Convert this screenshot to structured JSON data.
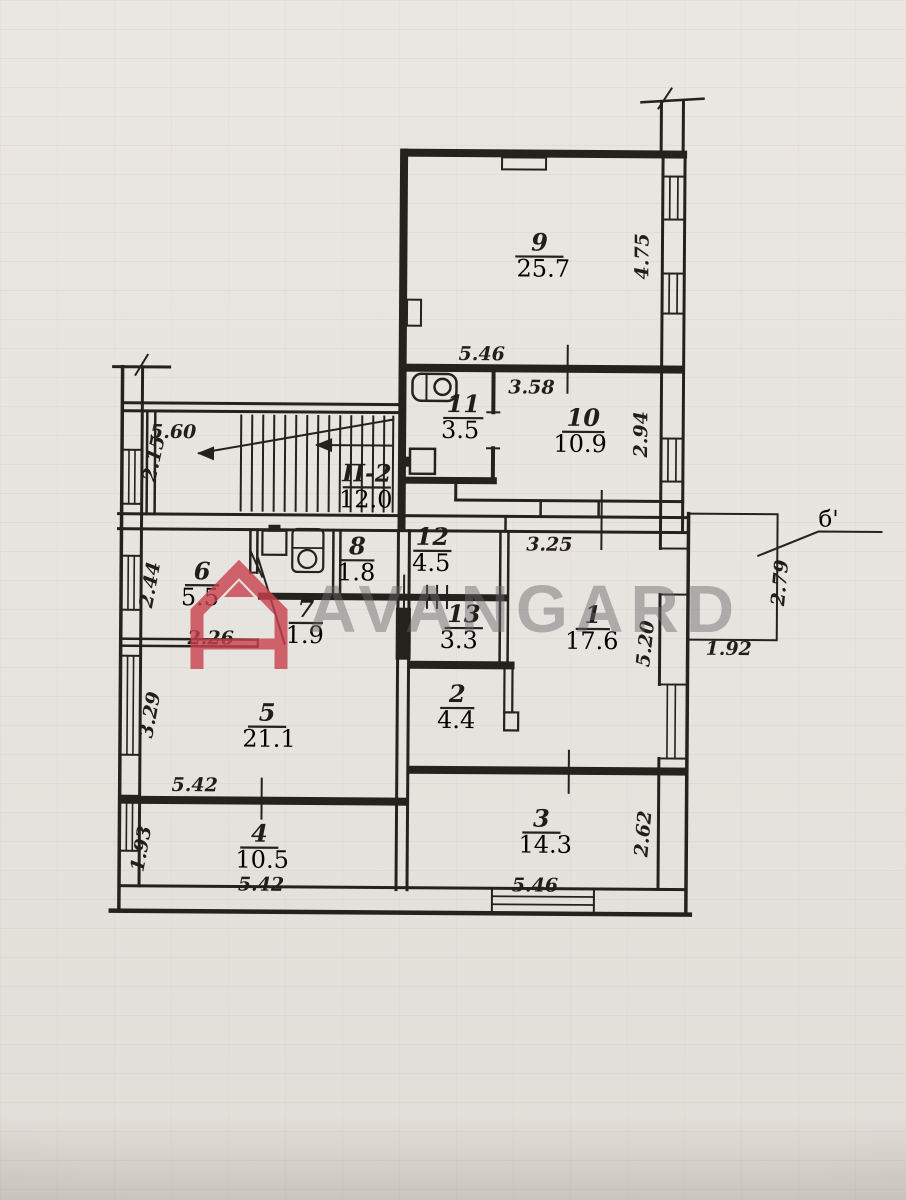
{
  "watermark": {
    "brand": "AVANGARD",
    "logo_letter": "A",
    "logo_color": "#c8414d"
  },
  "plan": {
    "stairs": {
      "label": "П-2",
      "area": "12.0"
    },
    "balcony": {
      "mark": "б'",
      "height": "2.79",
      "width": "1.92"
    },
    "rooms": {
      "r1": {
        "num": "1",
        "area": "17.6"
      },
      "r2": {
        "num": "2",
        "area": "4.4"
      },
      "r3": {
        "num": "3",
        "area": "14.3"
      },
      "r4": {
        "num": "4",
        "area": "10.5"
      },
      "r5": {
        "num": "5",
        "area": "21.1"
      },
      "r6": {
        "num": "6",
        "area": "5.5"
      },
      "r7": {
        "num": "7",
        "area": "1.9"
      },
      "r8": {
        "num": "8",
        "area": "1.8"
      },
      "r9": {
        "num": "9",
        "area": "25.7"
      },
      "r10": {
        "num": "10",
        "area": "10.9"
      },
      "r11": {
        "num": "11",
        "area": "3.5"
      },
      "r12": {
        "num": "12",
        "area": "4.5"
      },
      "r13": {
        "num": "13",
        "area": "3.3"
      }
    },
    "dims": {
      "room9_side": "4.75",
      "top_width": "5.46",
      "room10_top": "3.58",
      "room10_side": "2.94",
      "stairs_width": "5.60",
      "stairs_side": "2.15",
      "hall_width": "3.25",
      "room6_side": "2.44",
      "room6_width": "2.26",
      "room1_side": "5.20",
      "room5_side": "3.29",
      "room5_width": "5.42",
      "room4_side": "1.93",
      "room4_width": "5.42",
      "room3_width": "5.46",
      "room3_side": "2.62"
    }
  }
}
